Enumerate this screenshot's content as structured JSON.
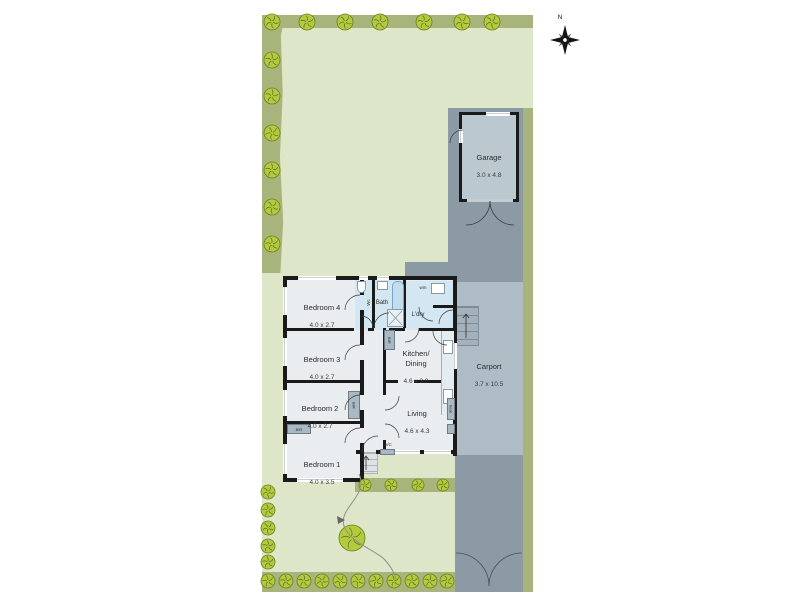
{
  "compass": {
    "north_label": "N"
  },
  "rooms": {
    "garage": {
      "name": "Garage",
      "dims": "3.0 x 4.8"
    },
    "carport": {
      "name": "Carport",
      "dims": "3.7 x 10.5"
    },
    "bedroom_4": {
      "name": "Bedroom 4",
      "dims": "4.0 x 2.7"
    },
    "bedroom_3": {
      "name": "Bedroom 3",
      "dims": "4.0 x 2.7"
    },
    "bedroom_2": {
      "name": "Bedroom 2",
      "dims": "4.0 x 2.7"
    },
    "bedroom_1": {
      "name": "Bedroom 1",
      "dims": "4.0 x 3.5"
    },
    "kitchen_dining": {
      "name": "Kitchen/\nDining",
      "dims": "4.6 x 3.0"
    },
    "living": {
      "name": "Living",
      "dims": "4.6 x 4.3"
    },
    "bath": {
      "name": "Bath"
    },
    "wc": {
      "name": "Wc"
    },
    "laundry": {
      "name": "L'dry"
    }
  },
  "fixtures": {
    "washing_machine": "wm",
    "air_conditioner": "A/C",
    "heater": "heat",
    "built_in_robe": "BIR"
  },
  "colors": {
    "lawn": "#dde6c8",
    "garden_bed": "#a7b47c",
    "tree": "#b5c93f",
    "paving": "#8c9aa6",
    "carport": "#aebcc6",
    "garage_floor": "#bcc8cf",
    "house_floor": "#e9edf0",
    "wet_area": "#d3e7f3",
    "wall": "#1a1a1a"
  }
}
